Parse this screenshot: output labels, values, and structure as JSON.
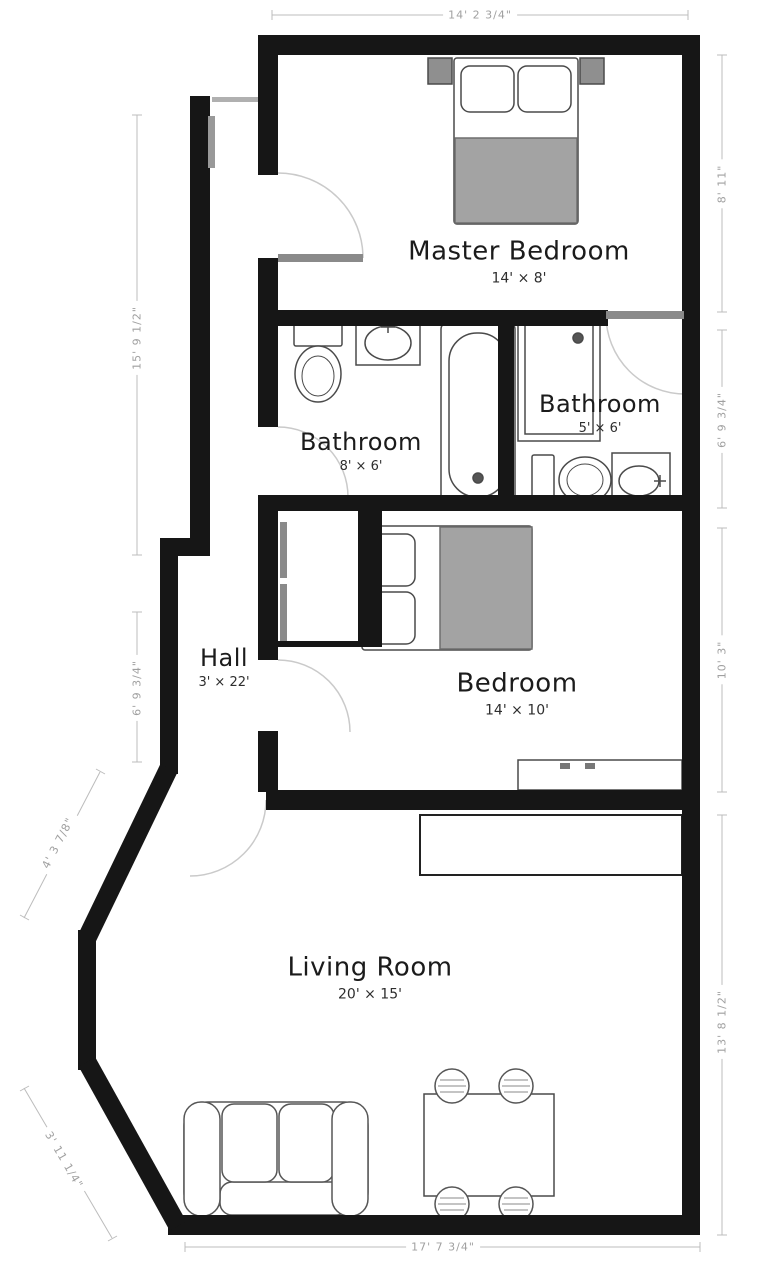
{
  "title": "Apartment Floor Plan",
  "rooms": {
    "master_bedroom": {
      "name": "Master Bedroom",
      "size": "14' × 8'"
    },
    "bathroom_1": {
      "name": "Bathroom",
      "size": "8' × 6'"
    },
    "bathroom_2": {
      "name": "Bathroom",
      "size": "5' × 6'"
    },
    "hall": {
      "name": "Hall",
      "size": "3' × 22'"
    },
    "bedroom": {
      "name": "Bedroom",
      "size": "14' × 10'"
    },
    "living_room": {
      "name": "Living Room",
      "size": "20' × 15'"
    }
  },
  "dimensions": {
    "top": "14' 2 3/4\"",
    "bottom": "17' 7 3/4\"",
    "left_upper": "15' 9 1/2\"",
    "left_lower": "6' 9 3/4\"",
    "right_master": "8' 11\"",
    "right_bath": "6' 9 3/4\"",
    "right_bedroom": "10' 3\"",
    "right_living": "13' 8 1/2\"",
    "diag_upper": "4' 3 7/8\"",
    "diag_lower": "3' 11 1/4\""
  },
  "furniture": {
    "master_bedroom": [
      "double-bed",
      "nightstand",
      "nightstand"
    ],
    "bathroom_1": [
      "toilet",
      "sink",
      "bathtub"
    ],
    "bathroom_2": [
      "shower",
      "toilet",
      "sink"
    ],
    "bedroom": [
      "double-bed",
      "dresser",
      "closet"
    ],
    "living_room": [
      "sofa",
      "dining-table",
      "chair",
      "chair",
      "chair",
      "chair",
      "counter"
    ]
  },
  "colors": {
    "wall": "#161616",
    "dimension_line": "#bcbcbc",
    "dimension_text": "#a0a0a0",
    "label_text": "#1b1b1b",
    "furniture_outline": "#4a4a4a",
    "blanket_fill": "#a3a3a3",
    "door_leaf": "#8a8a8a"
  }
}
